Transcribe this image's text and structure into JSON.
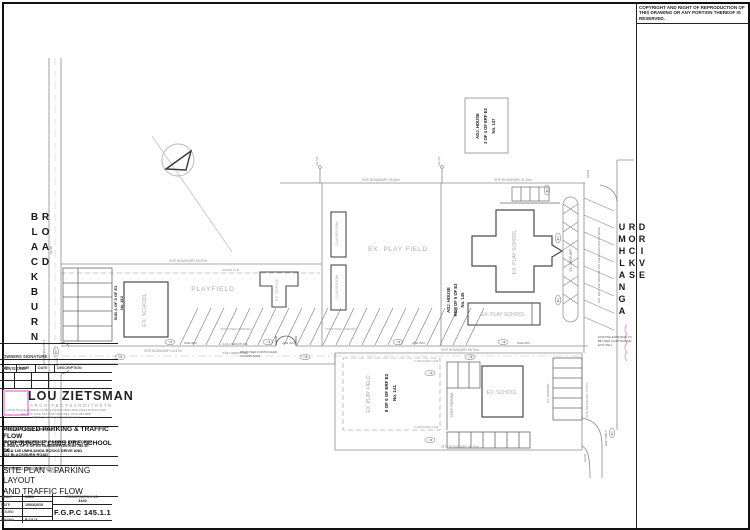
{
  "copyright": "COPYRIGHT AND RIGHT OF REPRODUCTION OF THIS DRAWING OR ANY PORTION THEREOF IS RESERVED.",
  "roads": {
    "left": "BLACKBURN ROAD",
    "right": "UMHLANGA ROCKS DRIVE"
  },
  "plan": {
    "labels": {
      "playfield": "PLAYFIELD",
      "ex_play_field": "EX. PLAY FIELD",
      "ex_school": "EX. SCHOOL",
      "ex_office": "EX. OFFICE",
      "classroom": "CLASSROOM",
      "ex_play_school": "EX. PLAY SCHOOL",
      "staff_parking": "STAFF PARKING",
      "ex_parking": "EX. PARKING",
      "ex_drop_off": "EX. DROP-OFF",
      "ext_parking": "EXT. EXISTING PARKING OFF UMHLANGA ROCKS DRIVE",
      "proposed_parking": "PROPOSED PARKING",
      "one_way": "ONE WAY",
      "servitude": "2.44m SERVITUDE",
      "water_line": "WATER LINE",
      "building_line": "7m BUILDING LINE",
      "gate_note_1": "PROPOSED CONTROLLED",
      "gate_note_2": "ACCESS GATE",
      "entrance_only": "ENTRANCE ONLY",
      "exit_only": "EXIT ONLY",
      "kerb": "KERB",
      "entry_note_1": "EXISTING ENTRANCE TO",
      "entry_note_2": "BE USED AS ENTRANCE/",
      "entry_note_3": "EXIT ONLY"
    },
    "erven": {
      "adj147_1": "ADJ. HOUSE",
      "adj147_2": "3 OF 4 OF ERF E2",
      "adj147_3": "No. 147",
      "adj145_1": "ADJ. HOUSE",
      "adj145_2": "REM OF 5 OF E3",
      "adj145_3": "No. 145",
      "erf141_1": "8 OF 6 OF ERF E2",
      "erf141_2": "No. 141",
      "erf412_1": "SUB A OF 5 OF E3",
      "erf412_2": "No. 412"
    },
    "dims": {
      "b_a": "SITE BOUNDARY 63.57m",
      "b_b": "SITE BOUNDARY 30.48m",
      "b_c": "SITE BOUNDARY 31.45m",
      "b_d": "SITE BOUNDARY 56.70m",
      "b_e": "SITE BOUNDARY 77.16m",
      "station": "(93.90)"
    }
  },
  "titleblock": {
    "owners_signature": "OWNERS SIGNATURE :",
    "revisions": {
      "title": "REVISIONS",
      "cols": [
        "REV.",
        "NAME",
        "DATE",
        "DESCRIPTION"
      ]
    },
    "firm": {
      "name": "LOU ZIETSMAN",
      "sub_left": "ARCHITECTS",
      "sub_right": "ARGITEKTE",
      "addr1": "3 PINE PLACE   DURBAN NORTH   P.O.BOX 888   UMHLANGA ROCKS   4320",
      "addr2": "TEL/FAX: (031) 563 0756        CELL/SEL: (072) 383 9887",
      "addr3": "EMAIL: louzietsman@telkomsa.net"
    },
    "project_label": "PROJECT DESCRIPTION:",
    "project_line1": "PROPOSED PARKING & TRAFFIC FLOW",
    "project_line2": "FOR JUNGLE CUBS PRE-SCHOOL cc.",
    "project_detail1": "ON COMBINED REM OF 5 OF E3 & 8 OF 6 OF E2",
    "project_detail2": "& SUB A OF 5 OF E3  GUNDERFONTEIN 785 AT",
    "project_detail3": "141 & 145 UMHLANGA ROCKS DRIVE AND",
    "project_detail4": "412 BLACKBURN ROAD",
    "drawing_label": "DRAWING DESCRIPTION:",
    "drawing_line1": "SITE PLAN – PARKING LAYOUT",
    "drawing_line2": "AND TRAFFIC FLOW",
    "info": {
      "scale_label": "SCALE",
      "scale": "1/500",
      "date_label": "DATE",
      "date": "19/03/2015",
      "issued_label": "ISSUED",
      "issued": "",
      "drawn_label": "DRAWN",
      "drawn": "B.C/LIZ",
      "reg_label": "REGISTRATION  NO.",
      "reg_no": "3440",
      "drawing_no": "F.G.P.C 145.1.1"
    },
    "architect_signature": "ARCHITECT'S SIGNATURE:"
  },
  "colors": {
    "accent": "#ec8ede",
    "line": "#555555",
    "grey_label": "#a6a6a6"
  }
}
